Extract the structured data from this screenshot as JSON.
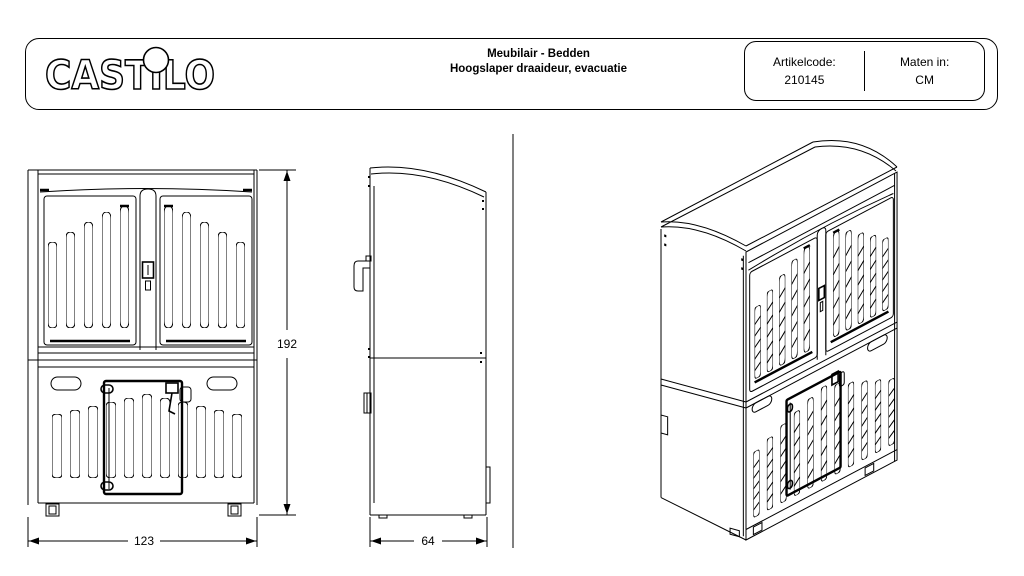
{
  "sheet": {
    "background": "#ffffff",
    "line_color": "#000000"
  },
  "header": {
    "logo": "CASTILO",
    "title_line1": "Meubilair - Bedden",
    "title_line2": "Hoogslaper draaideur, evacuatie",
    "article": {
      "label": "Artikelcode:",
      "value": "210145"
    },
    "units": {
      "label": "Maten in:",
      "value": "CM"
    }
  },
  "views": {
    "front": {
      "width_cm": "123",
      "height_cm": "192"
    },
    "side": {
      "depth_cm": "64"
    }
  }
}
